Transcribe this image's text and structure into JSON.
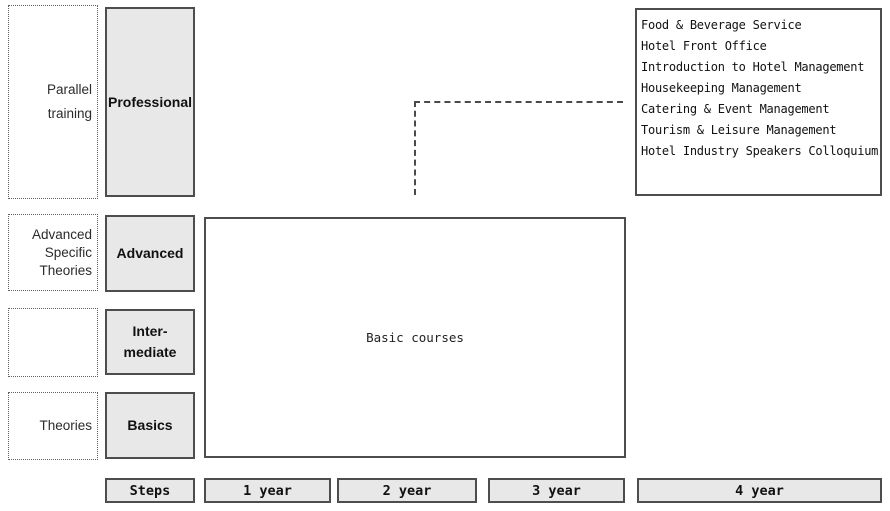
{
  "colors": {
    "box_fill": "#e8e8e8",
    "box_border": "#4d4d4d",
    "dotted_border": "#606060",
    "text": "#1a1a1a"
  },
  "left_column": {
    "parallel_training": {
      "line1": "Parallel",
      "line2": "training"
    },
    "advanced_specific_theories": {
      "line1": "Advanced",
      "line2": "Specific",
      "line3": "Theories"
    },
    "theories": {
      "line1": "Theories"
    }
  },
  "steps_column": {
    "professional": "Professional",
    "advanced": "Advanced",
    "intermediate_line1": "Inter-",
    "intermediate_line2": "mediate",
    "basics": "Basics"
  },
  "main": {
    "basic_courses_label": "Basic courses"
  },
  "professional_courses": {
    "items": [
      "Food & Beverage Service",
      "Hotel Front Office",
      "Introduction to Hotel Management",
      "Housekeeping Management",
      "Catering & Event Management",
      "Tourism & Leisure Management",
      "Hotel Industry Speakers Colloquium"
    ]
  },
  "timeline": {
    "steps": "Steps",
    "year1": "1 year",
    "year2": "2 year",
    "year3": "3 year",
    "year4": "4 year"
  }
}
